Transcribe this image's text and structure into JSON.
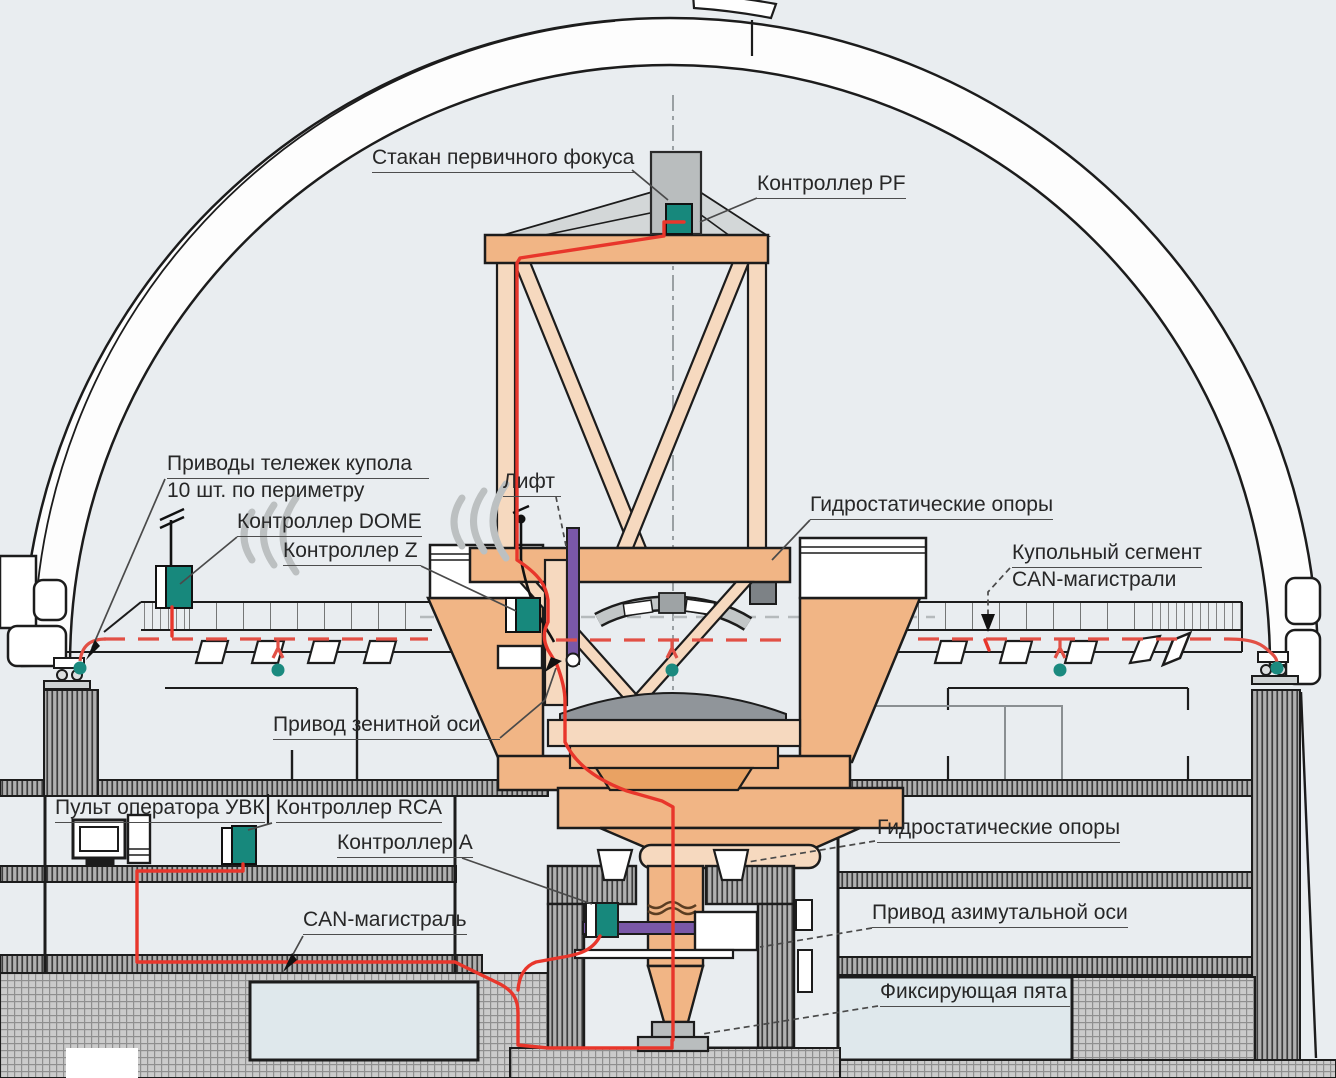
{
  "diagram": {
    "kind": "observatory-telescope-control-system-cross-section",
    "palette": {
      "background": "#e9edf0",
      "structure_orange": "#f1b585",
      "structure_light": "#f6d9bf",
      "structure_dark": "#e9a263",
      "controller_teal": "#17887c",
      "cable_red": "#e8362b",
      "can_dash_red": "#e25045",
      "drive_purple": "#7a58a8",
      "metal_gray": "#b9bdbe",
      "outline": "#1c1c1c"
    },
    "labels": {
      "primary_focus_cage": "Стакан первичного фокуса",
      "controller_pf": "Контроллер PF",
      "dome_cart_drives_line1": "Приводы тележек купола",
      "dome_cart_drives_line2": "10 шт. по периметру",
      "controller_dome": "Контроллер DOME",
      "controller_z": "Контроллер Z",
      "lift": "Лифт",
      "hydrostatic_supports_top": "Гидростатические опоры",
      "dome_segment_line1": "Купольный сегмент",
      "dome_segment_line2": "CAN-магистрали",
      "zenith_axis_drive": "Привод зенитной оси",
      "operator_console": "Пульт оператора УВК",
      "controller_rca": "Контроллер RCA",
      "controller_a": "Контроллер A",
      "can_bus": "CAN-магистраль",
      "hydrostatic_supports_bottom": "Гидростатические опоры",
      "azimuth_axis_drive": "Привод азимутальной оси",
      "fixing_heel": "Фиксирующая пята"
    }
  }
}
